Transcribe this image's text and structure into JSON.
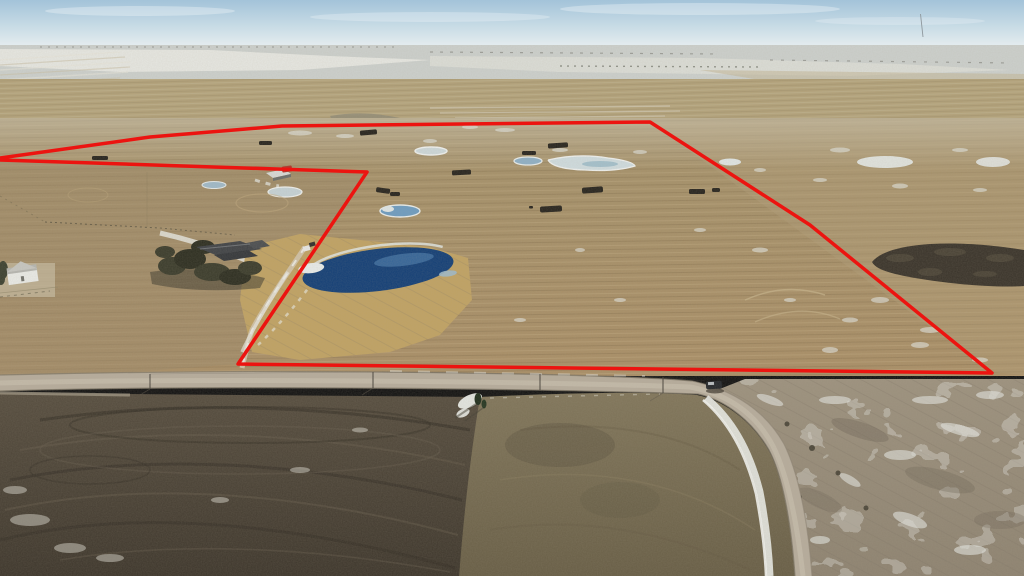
{
  "scene": {
    "kind": "aerial-drone-photo",
    "description": "Oblique winter aerial photo of prairie farmland; a large parcel is outlined in red. A gravel road runs along the south edge and curves away to the south-east. A treed farmstead acreage is notched out of the south-west corner of the parcel.",
    "boundary": {
      "color": "#ec1410",
      "stroke_width": 3.5,
      "points": "0,158 150,137 282,126 650,122 810,225 992,373 238,364 367,172 0,160"
    },
    "palette": {
      "sky_top": "#a3c3d9",
      "sky_horizon": "#e6edef",
      "distant_haze": "#ccd0cd",
      "snow": "#e9ebe7",
      "field_tan": "#a58d62",
      "stubble_gold": "#c0a263",
      "pond_deep_blue": "#123e76",
      "pond_ice": "#c5d2d6",
      "road_gravel": "#b6ac9c",
      "plowed_dark": "#463f33",
      "olive_field": "#756a50",
      "pasture_grey": "#93897a",
      "shelter_dark": "#26231d"
    },
    "landmarks": [
      {
        "name": "red-property-boundary",
        "x": 512,
        "y": 240
      },
      {
        "name": "farmstead-house-with-shelterbelt",
        "x": 228,
        "y": 252
      },
      {
        "name": "large-dugout-pond",
        "x": 378,
        "y": 269
      },
      {
        "name": "white-farmhouse-left-edge",
        "x": 25,
        "y": 276
      },
      {
        "name": "grey-barn-and-red-shed",
        "x": 280,
        "y": 173
      },
      {
        "name": "pickup-truck-on-road",
        "x": 714,
        "y": 386
      },
      {
        "name": "gravel-road-curving-south",
        "x": 790,
        "y": 470
      },
      {
        "name": "dark-summerfallow-field",
        "x": 230,
        "y": 480
      },
      {
        "name": "dark-burn-patch",
        "x": 948,
        "y": 265
      },
      {
        "name": "radio-tower-on-horizon",
        "x": 922,
        "y": 25
      },
      {
        "name": "cattle-windbreak-shelters",
        "x": 520,
        "y": 175
      },
      {
        "name": "frozen-sloughs",
        "x": 600,
        "y": 160
      }
    ]
  }
}
